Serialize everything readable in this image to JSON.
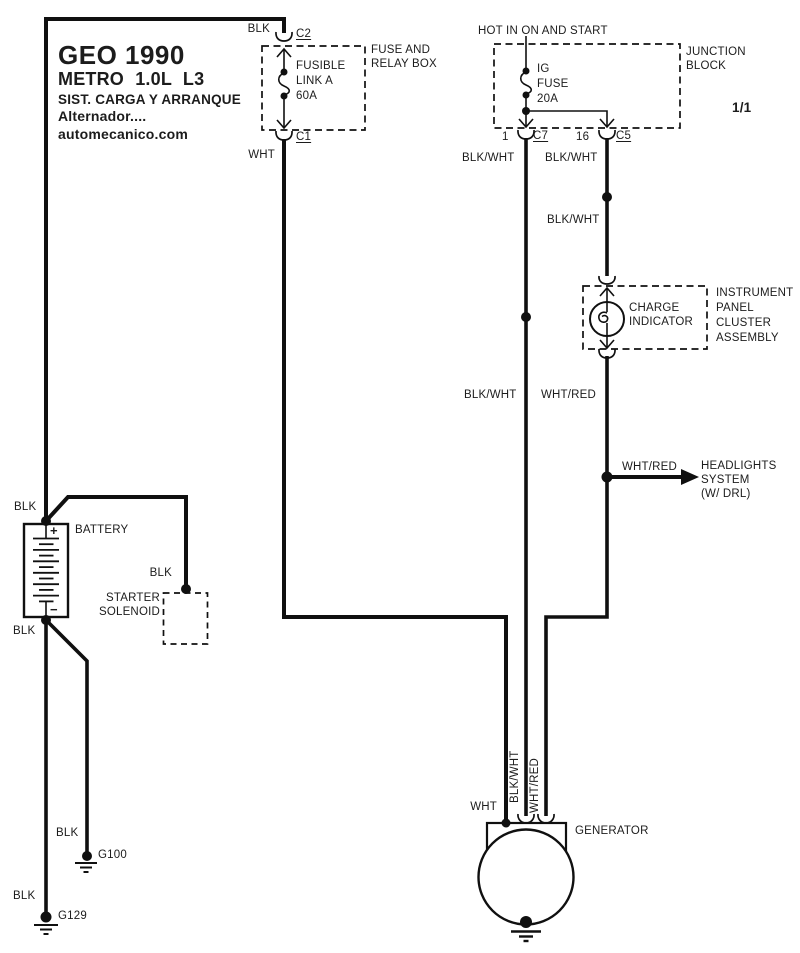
{
  "title_block": {
    "brand": "GEO 1990",
    "model": "METRO 1.0L L3",
    "system": "SIST. CARGA Y ARRANQUE",
    "subsystem": "Alternador....",
    "website": "automecanico.com"
  },
  "page_indicator": "1/1",
  "fuse_relay_box": {
    "title_line1": "FUSE AND",
    "title_line2": "RELAY BOX",
    "connector_top": "C2",
    "connector_bottom": "C1",
    "fusible_line1": "FUSIBLE",
    "fusible_line2": "LINK A",
    "fusible_line3": "60A",
    "wire_in": "BLK",
    "wire_out": "WHT"
  },
  "junction_block": {
    "hot_label": "HOT IN ON AND START",
    "title_line1": "JUNCTION",
    "title_line2": "BLOCK",
    "fuse_line1": "IG",
    "fuse_line2": "FUSE",
    "fuse_line3": "20A",
    "pin_c7": "1",
    "connector_c7": "C7",
    "pin_c5": "16",
    "connector_c5": "C5",
    "wire_c7": "BLK/WHT",
    "wire_c5": "BLK/WHT"
  },
  "instrument_cluster": {
    "wire_in": "BLK/WHT",
    "charge_line1": "CHARGE",
    "charge_line2": "INDICATOR",
    "title_line1": "INSTRUMENT",
    "title_line2": "PANEL",
    "title_line3": "CLUSTER",
    "title_line4": "ASSEMBLY"
  },
  "mid_wires": {
    "blk_wht": "BLK/WHT",
    "wht_red": "WHT/RED"
  },
  "headlights": {
    "wire": "WHT/RED",
    "line1": "HEADLIGHTS",
    "line2": "SYSTEM",
    "line3": "(W/ DRL)"
  },
  "battery": {
    "label": "BATTERY",
    "positive": "+",
    "negative": "−",
    "wire_top": "BLK",
    "wire_bottom": "BLK"
  },
  "starter_solenoid": {
    "line1": "STARTER",
    "line2": "SOLENOID",
    "wire": "BLK"
  },
  "generator": {
    "label": "GENERATOR",
    "wire_wht": "WHT",
    "wire_blk_wht": "BLK/WHT",
    "wire_wht_red": "WHT/RED"
  },
  "grounds": {
    "g100_label": "G100",
    "g100_wire": "BLK",
    "g129_label": "G129",
    "g129_wire": "BLK"
  },
  "colors": {
    "line": "#101010",
    "text": "#1c1c1c",
    "background": "#ffffff"
  }
}
